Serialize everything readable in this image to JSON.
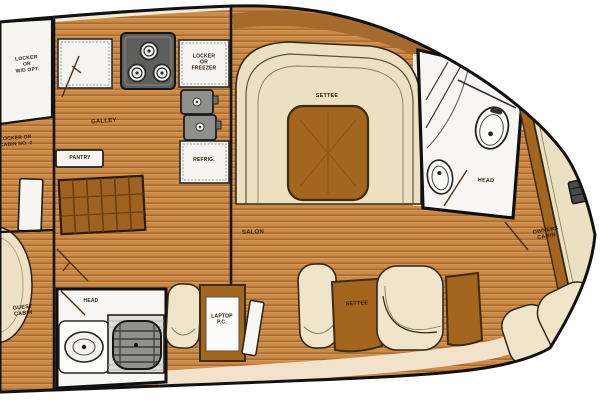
{
  "diagram": {
    "type": "yacht-interior-floor-plan",
    "labels": {
      "locker_wd": "LOCKER\nOR\nW/D OPT.",
      "locker_cabin2": "LOCKER OR\nCABIN NO. 2",
      "galley": "GALLEY",
      "pantry": "PANTRY",
      "locker_freezer": "LOCKER\nOR\nFREEZER",
      "refrig": "REFRIG.",
      "settee_upper": "SETTEE",
      "salon": "SALON",
      "head_forward": "HEAD",
      "owners_cabin": "OWNERS\nCABIN",
      "guest_cabin": "GUEST\nCABIN",
      "head_aft": "HEAD",
      "laptop": "LAPTOP\nP.C.",
      "settee_lower": "SETTEE"
    },
    "colors": {
      "hull_outline": "#111111",
      "wood_floor": "#cb8a45",
      "wood_dark": "#a4651f",
      "upholstery": "#ece0c2",
      "fixture_white": "#f7f6f4",
      "appliance_gray": "#8f8f8d",
      "walkway_band": "#f3e2cb"
    }
  }
}
